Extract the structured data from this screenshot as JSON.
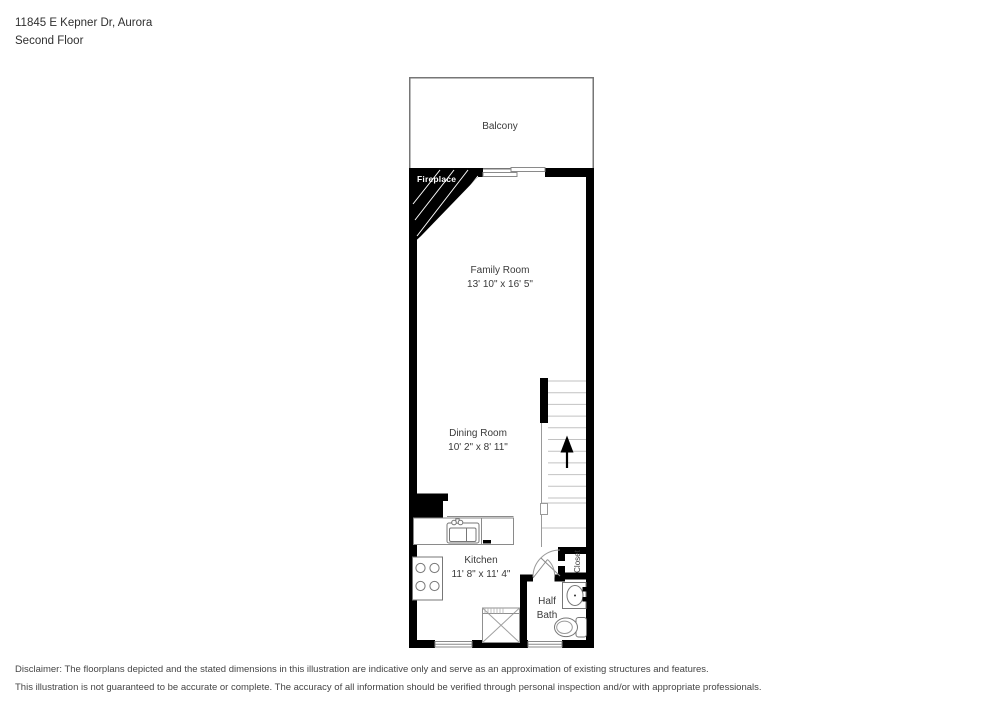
{
  "header": {
    "address": "11845 E Kepner Dr, Aurora",
    "floor": "Second Floor"
  },
  "plan": {
    "balcony": "Balcony",
    "fireplace": "Fireplace",
    "closet": "Closet",
    "family_room": {
      "name": "Family Room",
      "dims": "13' 10\" x 16' 5\""
    },
    "dining_room": {
      "name": "Dining Room",
      "dims": "10' 2\" x 8' 11\""
    },
    "kitchen": {
      "name": "Kitchen",
      "dims": "11' 8\" x 11' 4\""
    },
    "half_bath": {
      "line1": "Half",
      "line2": "Bath"
    },
    "stairs_direction": "up"
  },
  "disclaimer": {
    "line1": "Disclaimer: The floorplans depicted and the stated dimensions in this illustration are indicative only and serve as an approximation of existing structures and features.",
    "line2": "This illustration is not guaranteed to be accurate or complete. The accuracy of all information should be verified through personal inspection and/or with appropriate professionals."
  },
  "colors": {
    "wall": "#000000",
    "fixture_line": "#777777",
    "thin_line": "#8a8a8a",
    "tread_line": "#c2c2c2",
    "text": "#3a3a3a",
    "fireplace_text": "#ffffff"
  }
}
